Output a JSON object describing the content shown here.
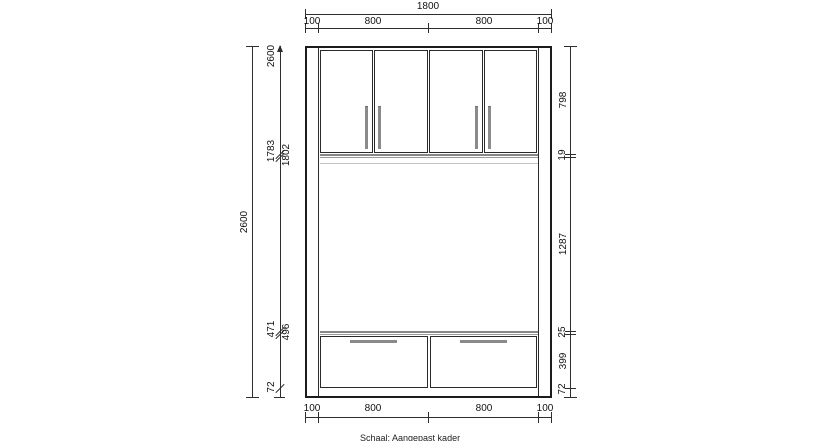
{
  "footer": {
    "scale_note": "Schaal: Aangepast kader"
  },
  "dimensions": {
    "top": {
      "total": "1800",
      "chain": [
        "100",
        "800",
        "800",
        "100"
      ]
    },
    "bottom": {
      "chain": [
        "100",
        "800",
        "800",
        "100"
      ]
    },
    "left": {
      "total": "2600",
      "ordinate_top_to_bottom": [
        "2600",
        "1802",
        "1783",
        "496",
        "471",
        "72"
      ]
    },
    "right": {
      "chain_top_to_bottom": [
        "798",
        "19",
        "1287",
        "25",
        "399",
        "72"
      ]
    }
  },
  "cabinet": {
    "upper_doors_count": "4",
    "drawers_count": "2"
  },
  "colors": {
    "background": "#ffffff",
    "cabinet_line": "#1c1c1c",
    "dimension_line": "#2e2e2e",
    "handle": "#8a8a8a",
    "shelf": "#8f8f8f"
  }
}
